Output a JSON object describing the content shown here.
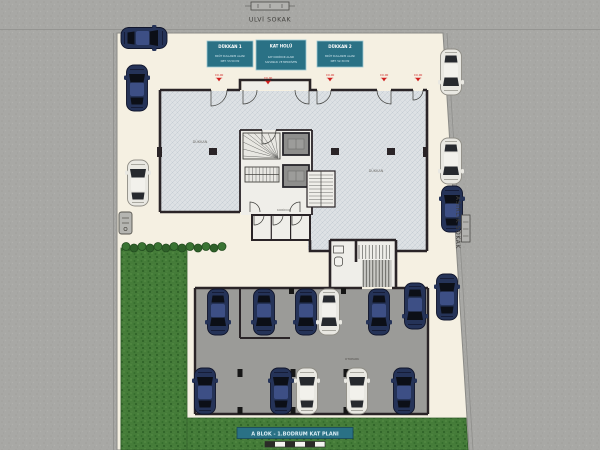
{
  "streets": {
    "top_label": "ULVİ SOKAK",
    "right_label": "ASIRLIK SOKAK"
  },
  "info_boxes": [
    {
      "title": "DÜKKAN 1",
      "line1": "BRÜT KULLANIM ALANI",
      "line2": "NET: 53.50 M2"
    },
    {
      "title": "KAT HOLÜ",
      "line1": "KAT KORİDOR ALANI",
      "line2": "SAHANLIK VE MERDİVEN"
    },
    {
      "title": "DÜKKAN 2",
      "line1": "BRÜT KULLANIM ALANI",
      "line2": "NET: 52.30 M2"
    }
  ],
  "plan": {
    "shop_left": "DÜKKAN",
    "shop_right": "DÜKKAN",
    "corridor": "KORİDOR",
    "garage": "OTOPARK",
    "level_marks": [
      "±0.00",
      "±0.00",
      "±0.00",
      "±0.00",
      "±0.00"
    ]
  },
  "footer": {
    "title": "A BLOK - 1.BODRUM KAT PLANI"
  },
  "palette": {
    "street": "#a8a8a5",
    "parcel": "#f5f0e2",
    "wall": "#2a2427",
    "hatch_floor": "#dde1e4",
    "garage_floor": "#9b9b98",
    "grass": "#457c39",
    "teal_accent": "#2a7185",
    "level_red": "#cf1f1f"
  },
  "site": {
    "car_colors": {
      "navy": {
        "body": "#253358",
        "glass": "#0c0f17",
        "roof": "#3d4f85",
        "trim": "#10152b"
      },
      "white": {
        "body": "#e9e8e2",
        "glass": "#26292e",
        "roof": "#f2f1ec",
        "trim": "#8f8d85"
      }
    },
    "cars": [
      {
        "x": 144,
        "y": 38,
        "rot": 90,
        "color": "navy"
      },
      {
        "x": 137,
        "y": 88,
        "rot": 0,
        "color": "navy"
      },
      {
        "x": 138,
        "y": 183,
        "rot": 0,
        "color": "white"
      },
      {
        "x": 451,
        "y": 72,
        "rot": 180,
        "color": "white"
      },
      {
        "x": 451,
        "y": 161,
        "rot": 180,
        "color": "white"
      },
      {
        "x": 452,
        "y": 209,
        "rot": 0,
        "color": "navy"
      },
      {
        "x": 447,
        "y": 297,
        "rot": 0,
        "color": "navy"
      },
      {
        "x": 218,
        "y": 312,
        "rot": 180,
        "color": "navy"
      },
      {
        "x": 264,
        "y": 312,
        "rot": 180,
        "color": "navy"
      },
      {
        "x": 306,
        "y": 312,
        "rot": 180,
        "color": "navy"
      },
      {
        "x": 329,
        "y": 312,
        "rot": 180,
        "color": "white"
      },
      {
        "x": 379,
        "y": 312,
        "rot": 180,
        "color": "navy"
      },
      {
        "x": 415,
        "y": 306,
        "rot": 180,
        "color": "navy"
      },
      {
        "x": 205,
        "y": 391,
        "rot": 0,
        "color": "navy"
      },
      {
        "x": 281,
        "y": 391,
        "rot": 0,
        "color": "navy"
      },
      {
        "x": 307,
        "y": 391,
        "rot": 0,
        "color": "white"
      },
      {
        "x": 357,
        "y": 391,
        "rot": 0,
        "color": "white"
      },
      {
        "x": 404,
        "y": 391,
        "rot": 0,
        "color": "navy"
      }
    ],
    "bushes": {
      "x_start": 126,
      "y": 247,
      "count": 13,
      "spacing": 8,
      "radius": 4
    }
  }
}
